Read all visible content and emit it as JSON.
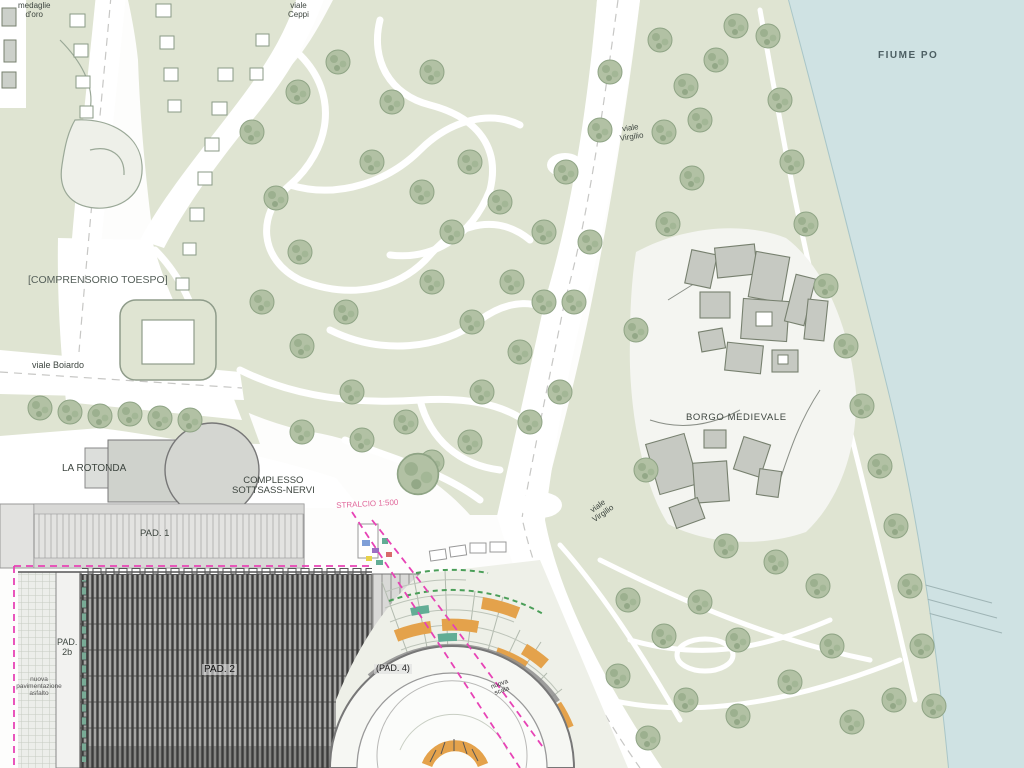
{
  "colors": {
    "park": "#dfe4d2",
    "parkLight": "#e9ece0",
    "tree": "#b2c1a4",
    "treeDark": "#93a887",
    "river": "#cfe2e3",
    "shore": "#a9c6c8",
    "road": "#ffffff",
    "roadEdge": "#b8c0b0",
    "building": "#ccd0ca",
    "buildingOutline": "#77806f",
    "borgoFill": "#c6c9c2",
    "padLight": "#e3e3e1",
    "hatchBase": "#a6a6a4",
    "hatchLine": "#3d3d3c",
    "magenta": "#e743b5",
    "orange": "#e4a24b",
    "teal": "#62ad95",
    "greenDash": "#4a9e58",
    "labelInk": "#3d453f",
    "stralcioPink": "#e0679a"
  },
  "labels": {
    "corso_top_left": {
      "lines": [
        "medaglie",
        "d'oro"
      ]
    },
    "viale_ceppi": {
      "lines": [
        "viale",
        "Ceppi"
      ]
    },
    "fiume_po": {
      "text": "FIUME PO"
    },
    "comprensorio_toespo": {
      "text": "[COMPRENSORIO TOESPO]"
    },
    "viale_boiardo": {
      "text": "viale Boiardo"
    },
    "viale_virgilio_nord": {
      "lines": [
        "viale",
        "Virgilio"
      ]
    },
    "viale_virgilio_sud": {
      "lines": [
        "viale",
        "Virgilio"
      ]
    },
    "borgo_medievale": {
      "text": "BORGO MEDIEVALE"
    },
    "la_rotonda": {
      "text": "LA ROTONDA"
    },
    "complesso_sottsass_nervi": {
      "lines": [
        "COMPLESSO",
        "SOTTSASS-NERVI"
      ]
    },
    "stralcio": {
      "text": "STRALCIO 1:500"
    },
    "pad_1": {
      "text": "PAD. 1"
    },
    "pad_2b": {
      "lines": [
        "PAD.",
        "2b"
      ]
    },
    "pad_2": {
      "text": "PAD. 2"
    },
    "pad_4": {
      "text": "(PAD. 4)"
    },
    "nuova_pavimentazione": {
      "lines": [
        "nuova",
        "pavimentazione",
        "asfalto"
      ]
    },
    "nuova_scala": {
      "lines": [
        "nuova",
        "scala"
      ]
    }
  }
}
